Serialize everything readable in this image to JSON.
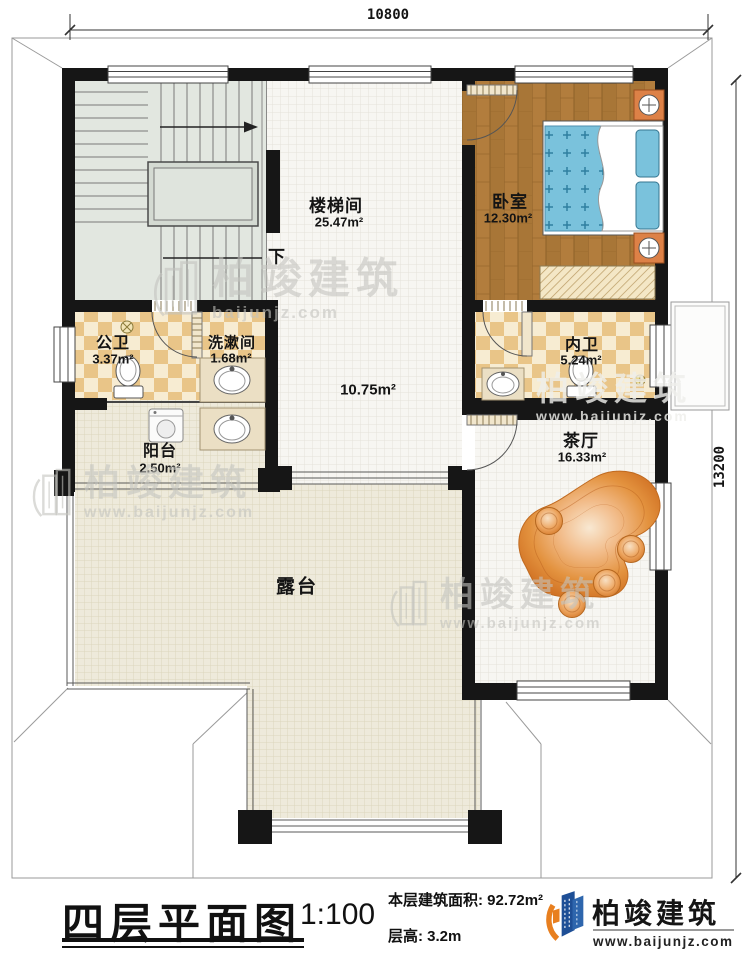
{
  "title_block": {
    "plan_title": "四层平面图",
    "scale": "1:100",
    "area_label": "本层建筑面积: ",
    "area_value": "92.72m²",
    "height_label": "层高: ",
    "height_value": "3.2m"
  },
  "dimensions": {
    "width_mm": "10800",
    "height_mm": "13200"
  },
  "rooms": {
    "stairwell": {
      "name": "楼梯间",
      "area": "25.47m²"
    },
    "hall": {
      "area": "10.75m²"
    },
    "bedroom": {
      "name": "卧室",
      "area": "12.30m²"
    },
    "public_bath": {
      "name": "公卫",
      "area": "3.37m²"
    },
    "washroom": {
      "name": "洗漱间",
      "area": "1.68m²"
    },
    "ensuite_bath": {
      "name": "内卫",
      "area": "5.24m²"
    },
    "balcony": {
      "name": "阳台",
      "area": "2.50m²"
    },
    "tea_room": {
      "name": "茶厅",
      "area": "16.33m²"
    },
    "terrace": {
      "name": "露台"
    }
  },
  "stairs": {
    "direction_label": "下"
  },
  "brand": {
    "name": "柏竣建筑",
    "website": "www.baijunjz.com"
  },
  "watermark": {
    "name": "柏竣建筑",
    "website": "www.baijunjz.com",
    "website_short": "baijunjz.com"
  },
  "colors": {
    "wall": "#161616",
    "wood_floor": "#b27d3d",
    "bath_tile": "#e9c588",
    "terrace_floor": "#eeeadb",
    "bed_blue": "#7ac2dc",
    "accent_orange": "#e87f1f",
    "brand_blue": "#1e4f96"
  }
}
